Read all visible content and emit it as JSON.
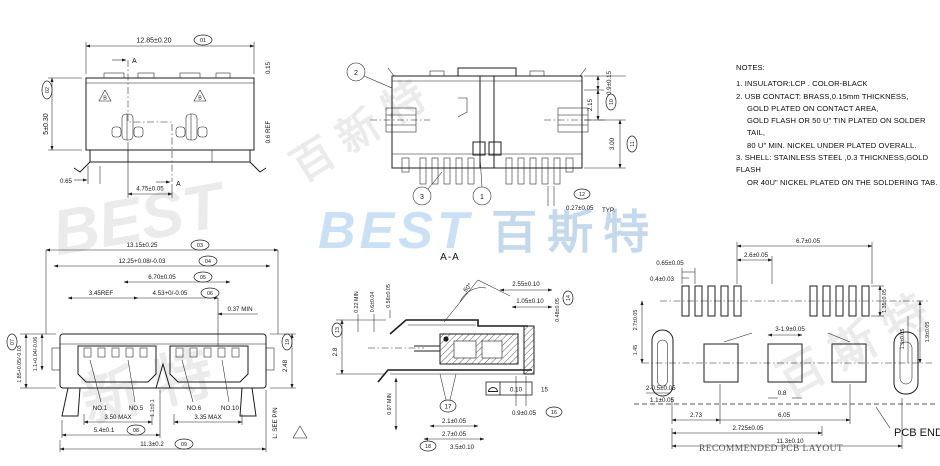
{
  "colors": {
    "line": "#1c1c1c",
    "watermark_blue": "#9ec8ec",
    "watermark_gray": "#d9d9d9"
  },
  "watermarks": {
    "blue_best": "BEST",
    "blue_cn": "百斯特",
    "gray_a": "BEST",
    "gray_b": "百 新 特",
    "gray_c": "百 斯 特",
    "gray_d": "新 特"
  },
  "notes": {
    "title": "NOTES:",
    "lines": [
      "1. INSULATOR:LCP . COLOR-BLACK",
      "2. USB CONTACT: BRASS,0.15mm THICKNESS,",
      "GOLD PLATED ON CONTACT AREA,",
      "GOLD FLASH OR 50 U\" TIN PLATED ON SOLDER TAIL,",
      "80 U\" MIN. NICKEL UNDER PLATED OVERALL.",
      "3. SHELL: STAINLESS STEEL ,0.3 THICKNESS,GOLD FLASH",
      "OR 40U\" NICKEL PLATED ON THE SOLDERING TAB."
    ]
  },
  "views": {
    "top": {
      "d_width": "12.85±0.20",
      "d_width_id": "01",
      "d_height": "5±0.30",
      "d_height_id": "02",
      "d_lip": "0.15",
      "d_ref": "0.6 REF",
      "d_tab": "0.65",
      "d_pitch": "4.75±0.05",
      "section": "A",
      "datum": "B"
    },
    "bottom": {
      "balloon_1": "1",
      "balloon_2": "2",
      "balloon_3": "3",
      "d_tail": "0.9±0.15",
      "d_tail_id": "10",
      "d_step": "2.15",
      "d_depth": "3.00",
      "d_depth_id": "11",
      "d_pin": "0.27±0.05",
      "d_pin_id": "12",
      "d_pin_suffix": "TYP."
    },
    "front": {
      "d_shell": "13.15±0.25",
      "d_shell_id": "03",
      "d_inner": "12.25+0.08/-0.03",
      "d_inner_id": "04",
      "d_ports": "6.70±0.05",
      "d_ports_id": "05",
      "d_ref": "3.45REF",
      "d_port": "4.53+0/-0.05",
      "d_port_id": "06",
      "d_min": "0.37 MIN",
      "d_h1": "1.85+0.05/-0.03",
      "d_h1_id": "07",
      "d_h2": "1.1+0.04/-0.06",
      "d_h3": "2.48",
      "d_h3_id": "19",
      "pin1": "NO.1",
      "pin5": "NO.5",
      "pin6": "NO.6",
      "pin10": "NO.10",
      "d_max1": "3.50 MAX",
      "d_max2": "3.35 MAX",
      "d_center": "1.1±0.1",
      "d_feet": "5.4±0.1",
      "d_feet_id": "08",
      "d_span": "11.3±0.2",
      "d_span_id": "09",
      "l_note": "L: SEE P/N"
    },
    "section": {
      "title": "A-A",
      "d_022": "0.22 MIN",
      "d_06": "0.6±0.04",
      "d_056": "0.56±0.05",
      "d_28": "2.8",
      "d_28_id": "13",
      "angle": "60°",
      "d_255": "2.55±0.10",
      "d_105": "1.05±0.10",
      "d_048": "0.48±0.05",
      "d_048_id": "14",
      "gdt_val": "0.10",
      "gdt_num": "15",
      "d_09": "0.9±0.05",
      "d_09_id": "16",
      "d_097": "0.97 MIN",
      "balloon_17": "17",
      "d_21": "2.1±0.05",
      "d_27": "2.7±0.05",
      "d_35": "3.5±0.10",
      "d_35_id": "18"
    },
    "pcb": {
      "d_67": "6.7±0.05",
      "d_26": "2.6±0.05",
      "d_065": "0.65±0.05",
      "d_04": "0.4±0.03",
      "d_135": "1.35±0.05",
      "d_19": "1.9±0.05",
      "d_13": "1.3±0.05",
      "d_pads": "3-1.9±0.05",
      "d_08": "0.8",
      "d_27l": "2.7±0.05",
      "d_145": "1.45",
      "d_slot": "2-0.5±0.05",
      "d_11": "1.1±0.05",
      "d_273": "2.73",
      "d_605": "6.05",
      "d_2725": "2.725±0.05",
      "d_113": "11.3±0.10",
      "pcb_end": "PCB END",
      "caption": "RECOMMENDED PCB LAYOUT"
    }
  }
}
